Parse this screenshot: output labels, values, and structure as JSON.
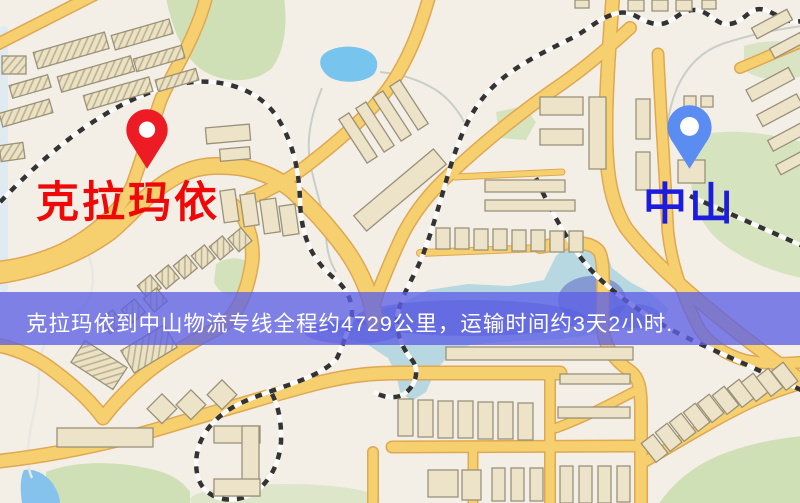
{
  "app": {
    "type": "logistics-route-map",
    "width": 800,
    "height": 503
  },
  "markers": {
    "origin": {
      "label": "克拉玛依",
      "label_color": "#ee0808",
      "pin_color": "#ed1c24"
    },
    "destination": {
      "label": "中山",
      "label_color": "#1c1ce0",
      "pin_color": "#5b8cf2"
    }
  },
  "banner": {
    "text": "克拉玛依到中山物流专线全程约4729公里，运输时间约3天2小时.",
    "background": "rgba(93,96,229,0.78)",
    "text_color": "#ffffff"
  },
  "map": {
    "colors": {
      "base": "#f3efe7",
      "road": "#f6cf6f",
      "road_edge": "#dfa852",
      "railway_base": "#fbfbf9",
      "railway_dash": "#333333",
      "water": "#b3d5e0",
      "water_dark": "#4a50c4",
      "lake": "#77c4ee",
      "park": "#cfe0b6",
      "building": "#ece3c9",
      "building_edge": "#9a9179",
      "stream": "#c8cfc8"
    }
  }
}
